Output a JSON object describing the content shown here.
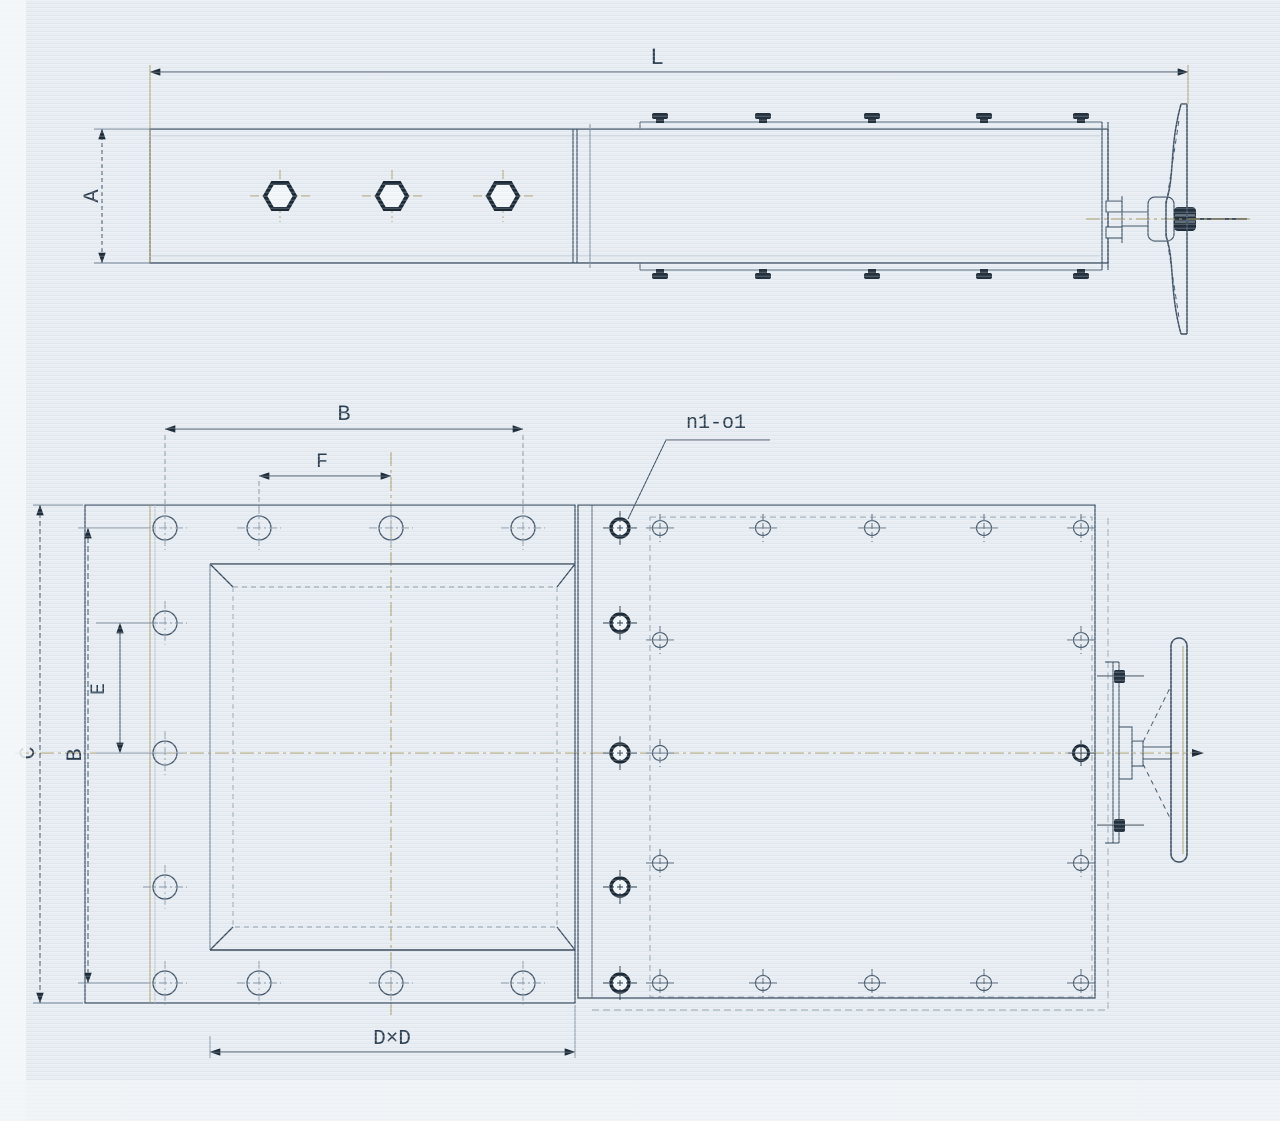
{
  "drawing": {
    "type": "engineering-drawing",
    "subject": "manual slide gate valve, two orthographic views",
    "colors": {
      "paper": "#e7edf2",
      "ink": "#44566a",
      "ink_dark": "#1f2c3a",
      "centerline": "#a89a66",
      "label_text": "#2d3e50"
    },
    "labels": {
      "top": {
        "length": "L",
        "body_height": "A"
      },
      "front": {
        "bolt_span_h": "B",
        "hole_pitch_h": "F",
        "holes": "n1-o1",
        "overall_height": "C",
        "bolt_span_v": "B",
        "hole_pitch_v": "E",
        "opening": "D×D"
      }
    }
  }
}
